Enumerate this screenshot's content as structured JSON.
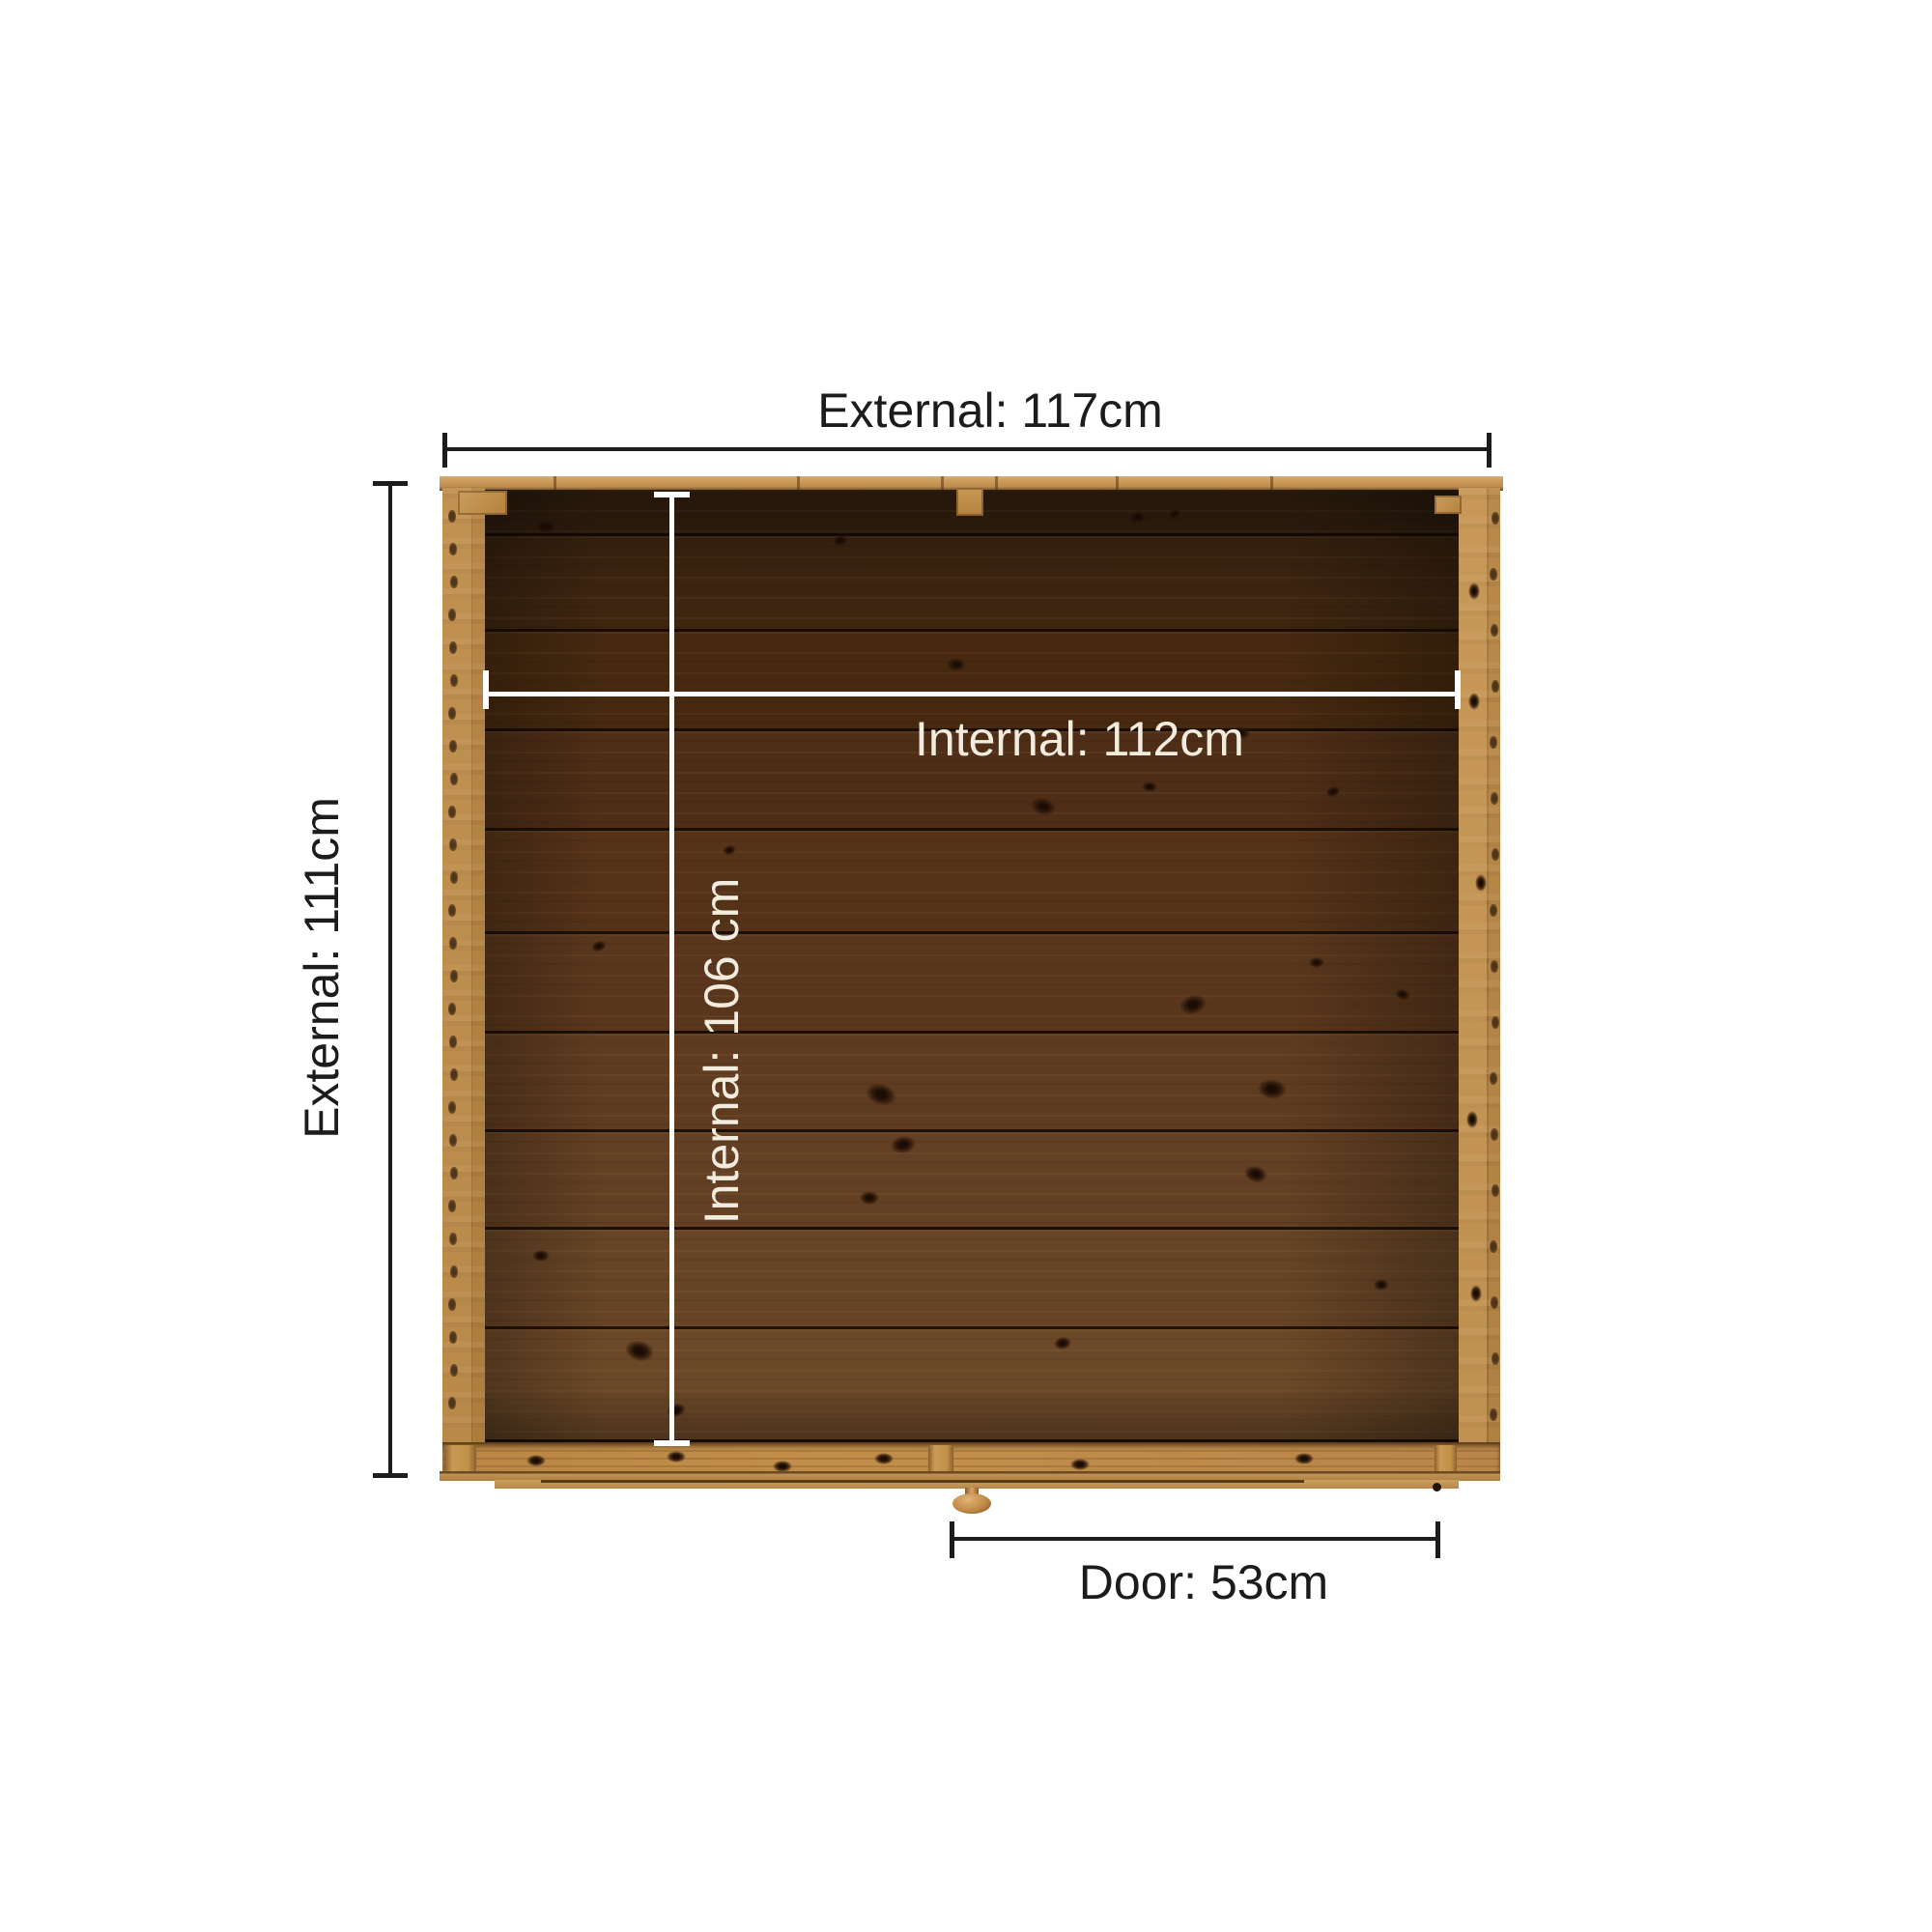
{
  "title": "Wooden garden store plan-view dimension diagram",
  "diagram": {
    "view": "top-down plan of timber shed / garden storage unit",
    "labels": {
      "external_width": "External: 117cm",
      "external_depth": "External: 111cm",
      "internal_width": "Internal: 112cm",
      "internal_depth": "Internal: 106 cm",
      "door_width": "Door: 53cm"
    },
    "values": {
      "external_width_cm": 117,
      "external_depth_cm": 111,
      "internal_width_cm": 112,
      "internal_depth_cm": 106,
      "door_width_cm": 53
    },
    "colors": {
      "background": "#ffffff",
      "dimension_line": "#1c1c1c",
      "dimension_text": "#1c1c1c",
      "internal_dimension_line": "#ffffff",
      "internal_dimension_text": "#f2ecdf",
      "frame_wood": "#b8864a",
      "frame_wood_light": "#c99e5e",
      "interior_plank_dark": "#34200f",
      "interior_plank_light": "#6b4827"
    }
  }
}
